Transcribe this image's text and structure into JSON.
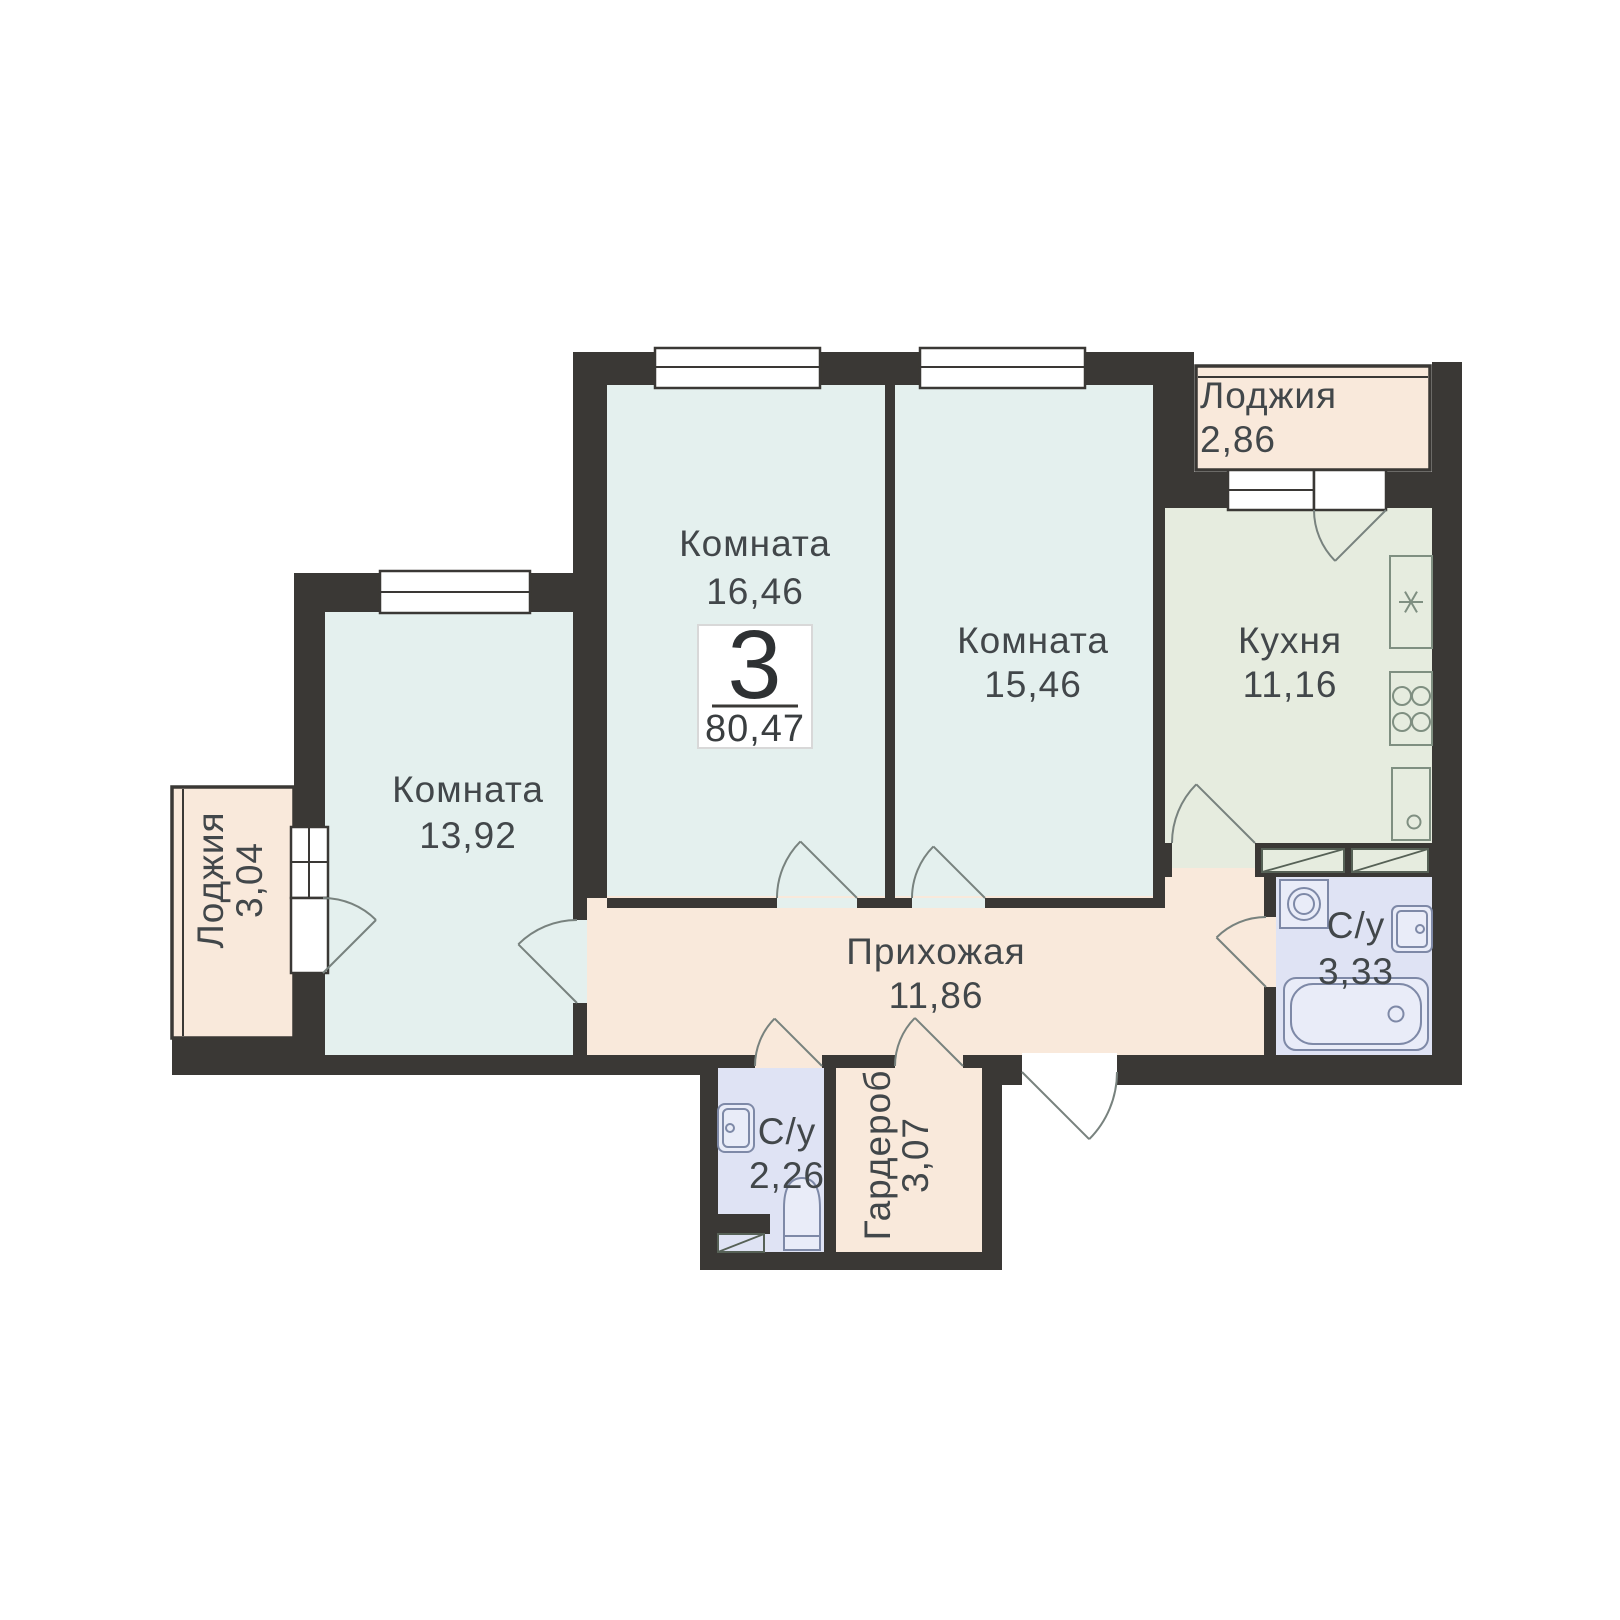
{
  "plan": {
    "badge": {
      "rooms_count": "3",
      "total_area": "80,47"
    },
    "rooms": {
      "room_a": {
        "label": "Комната",
        "area": "16,46"
      },
      "room_b": {
        "label": "Комната",
        "area": "15,46"
      },
      "room_c": {
        "label": "Комната",
        "area": "13,92"
      },
      "kitchen": {
        "label": "Кухня",
        "area": "11,16"
      },
      "hallway": {
        "label": "Прихожая",
        "area": "11,86"
      },
      "loggia_top": {
        "label": "Лоджия",
        "area": "2,86"
      },
      "loggia_left": {
        "label": "Лоджия",
        "area": "3,04"
      },
      "bathroom_main": {
        "label": "С/у",
        "area": "3,33"
      },
      "bathroom_small": {
        "label": "С/у",
        "area": "2,26"
      },
      "wardrobe": {
        "label": "Гардероб",
        "area": "3,07"
      }
    },
    "colors": {
      "wall": "#3a3835",
      "room": "#e4f0ee",
      "kitchen": "#e6ecdf",
      "hall": "#f9e9db",
      "bath": "#dfe3f4",
      "white": "#ffffff"
    },
    "fixtures": {
      "kitchen": [
        "kitchen-sink-icon",
        "stove-icon",
        "fridge-icon",
        "kitchen-cabinet-icon"
      ],
      "bathroom_main": [
        "washing-machine-icon",
        "sink-icon",
        "bathtub-icon"
      ],
      "bathroom_small": [
        "sink-icon",
        "toilet-icon"
      ]
    }
  }
}
